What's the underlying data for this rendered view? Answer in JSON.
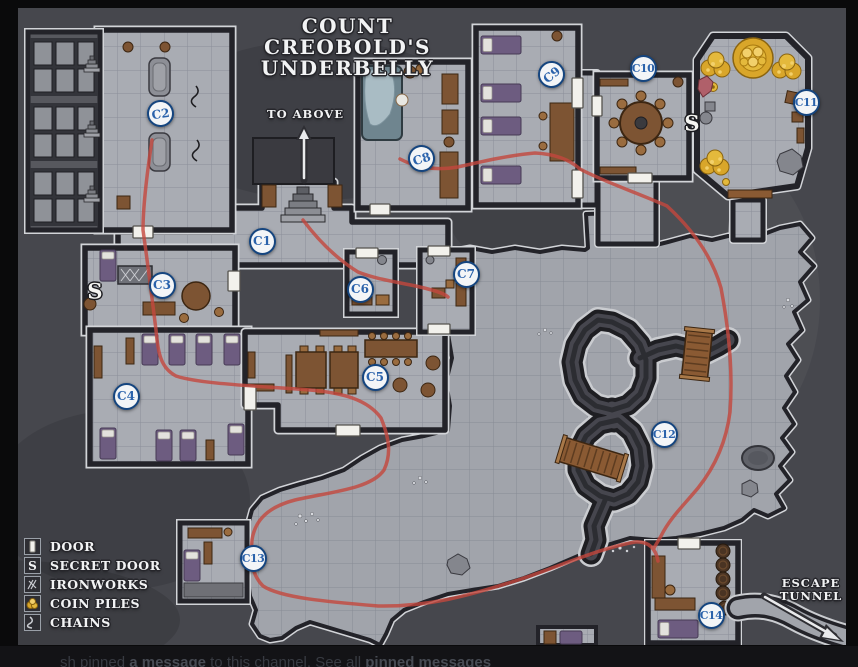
{
  "title": {
    "line1": "COUNT CREOBOLD'S",
    "line2": "UNDERBELLY"
  },
  "annotations": {
    "to_above": "TO ABOVE",
    "escape_line1": "ESCAPE",
    "escape_line2": "TUNNEL"
  },
  "room_markers": [
    {
      "id": "C1",
      "x": 262,
      "y": 241,
      "rot": 0
    },
    {
      "id": "C2",
      "x": 160,
      "y": 113,
      "rot": -8
    },
    {
      "id": "C3",
      "x": 162,
      "y": 285,
      "rot": 0
    },
    {
      "id": "C4",
      "x": 126,
      "y": 396,
      "rot": 0
    },
    {
      "id": "C5",
      "x": 375,
      "y": 377,
      "rot": 0
    },
    {
      "id": "C6",
      "x": 360,
      "y": 289,
      "rot": 0
    },
    {
      "id": "C7",
      "x": 466,
      "y": 274,
      "rot": 0
    },
    {
      "id": "C8",
      "x": 421,
      "y": 158,
      "rot": -18
    },
    {
      "id": "C9",
      "x": 551,
      "y": 74,
      "rot": -40
    },
    {
      "id": "C10",
      "x": 643,
      "y": 68,
      "rot": 0
    },
    {
      "id": "C11",
      "x": 806,
      "y": 102,
      "rot": 0
    },
    {
      "id": "C12",
      "x": 664,
      "y": 434,
      "rot": 0
    },
    {
      "id": "C13",
      "x": 253,
      "y": 558,
      "rot": 0
    },
    {
      "id": "C14",
      "x": 711,
      "y": 615,
      "rot": 0
    }
  ],
  "secret_doors": [
    {
      "label": "S",
      "x": 95,
      "y": 292
    },
    {
      "label": "S",
      "x": 692,
      "y": 124
    }
  ],
  "legend": {
    "items": [
      {
        "label": "DOOR",
        "icon": "door-icon"
      },
      {
        "label": "SECRET DOOR",
        "icon": "secret-door-icon"
      },
      {
        "label": "IRONWORKS",
        "icon": "ironworks-icon"
      },
      {
        "label": "COIN PILES",
        "icon": "coin-piles-icon"
      },
      {
        "label": "CHAINS",
        "icon": "chains-icon"
      }
    ]
  },
  "bottom_bar": {
    "parts": [
      {
        "text": "sh pinned ",
        "bold": false
      },
      {
        "text": "a message",
        "bold": true
      },
      {
        "text": " to this channel. See all ",
        "bold": false
      },
      {
        "text": "pinned messages",
        "bold": true
      }
    ]
  },
  "colors": {
    "route_red": "#c4473d",
    "marker_blue": "#2a62ab",
    "marker_border": "#15457f",
    "coin_gold": "#d9a62a"
  }
}
